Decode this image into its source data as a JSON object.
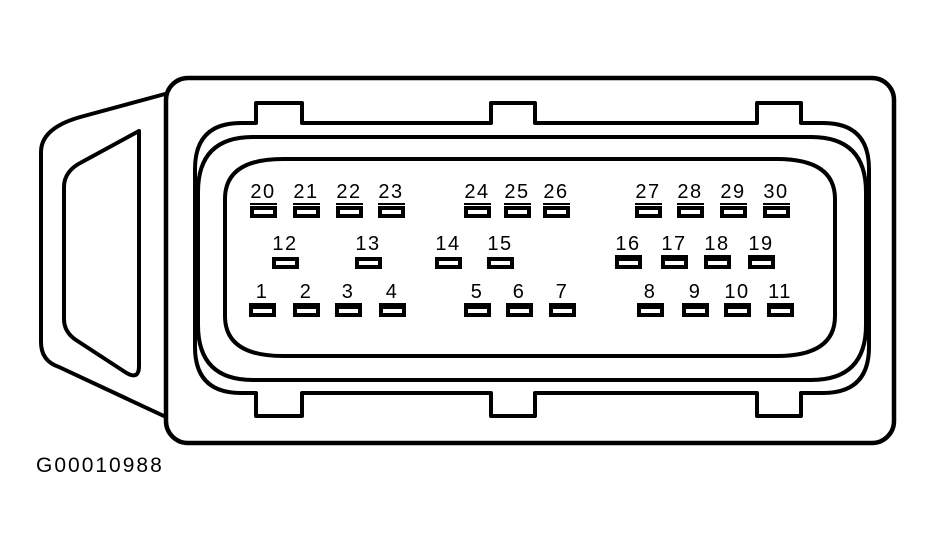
{
  "figure": {
    "caption": "G00010988",
    "background": "#ffffff",
    "line_color": "#000000"
  },
  "connector": {
    "pin_count": 30,
    "rows": {
      "top": {
        "label_top": 182,
        "pad_top": 206
      },
      "middle": {
        "label_top": 234,
        "pad_top": 257
      },
      "bottom": {
        "label_top": 282,
        "pad_top": 305
      }
    },
    "pins": [
      {
        "n": "20",
        "row": "top",
        "cx": 263,
        "underline": true
      },
      {
        "n": "21",
        "row": "top",
        "cx": 306,
        "underline": true
      },
      {
        "n": "22",
        "row": "top",
        "cx": 349,
        "underline": true
      },
      {
        "n": "23",
        "row": "top",
        "cx": 391,
        "underline": true
      },
      {
        "n": "24",
        "row": "top",
        "cx": 477,
        "underline": true
      },
      {
        "n": "25",
        "row": "top",
        "cx": 517,
        "underline": true
      },
      {
        "n": "26",
        "row": "top",
        "cx": 556,
        "underline": true
      },
      {
        "n": "27",
        "row": "top",
        "cx": 648,
        "underline": true
      },
      {
        "n": "28",
        "row": "top",
        "cx": 690,
        "underline": true
      },
      {
        "n": "29",
        "row": "top",
        "cx": 733,
        "underline": true
      },
      {
        "n": "30",
        "row": "top",
        "cx": 776,
        "underline": true
      },
      {
        "n": "12",
        "row": "middle",
        "cx": 285,
        "underline": false
      },
      {
        "n": "13",
        "row": "middle",
        "cx": 368,
        "underline": false
      },
      {
        "n": "14",
        "row": "middle",
        "cx": 448,
        "underline": false
      },
      {
        "n": "15",
        "row": "middle",
        "cx": 500,
        "underline": false
      },
      {
        "n": "16",
        "row": "middle",
        "cx": 628,
        "underline": true
      },
      {
        "n": "17",
        "row": "middle",
        "cx": 674,
        "underline": true
      },
      {
        "n": "18",
        "row": "middle",
        "cx": 717,
        "underline": true
      },
      {
        "n": "19",
        "row": "middle",
        "cx": 761,
        "underline": true
      },
      {
        "n": "1",
        "row": "bottom",
        "cx": 262,
        "underline": true
      },
      {
        "n": "2",
        "row": "bottom",
        "cx": 306,
        "underline": true
      },
      {
        "n": "3",
        "row": "bottom",
        "cx": 348,
        "underline": true
      },
      {
        "n": "4",
        "row": "bottom",
        "cx": 392,
        "underline": true
      },
      {
        "n": "5",
        "row": "bottom",
        "cx": 477,
        "underline": true
      },
      {
        "n": "6",
        "row": "bottom",
        "cx": 519,
        "underline": true
      },
      {
        "n": "7",
        "row": "bottom",
        "cx": 562,
        "underline": true
      },
      {
        "n": "8",
        "row": "bottom",
        "cx": 650,
        "underline": true
      },
      {
        "n": "9",
        "row": "bottom",
        "cx": 695,
        "underline": true
      },
      {
        "n": "10",
        "row": "bottom",
        "cx": 737,
        "underline": true
      },
      {
        "n": "11",
        "row": "bottom",
        "cx": 780,
        "underline": true
      }
    ]
  }
}
